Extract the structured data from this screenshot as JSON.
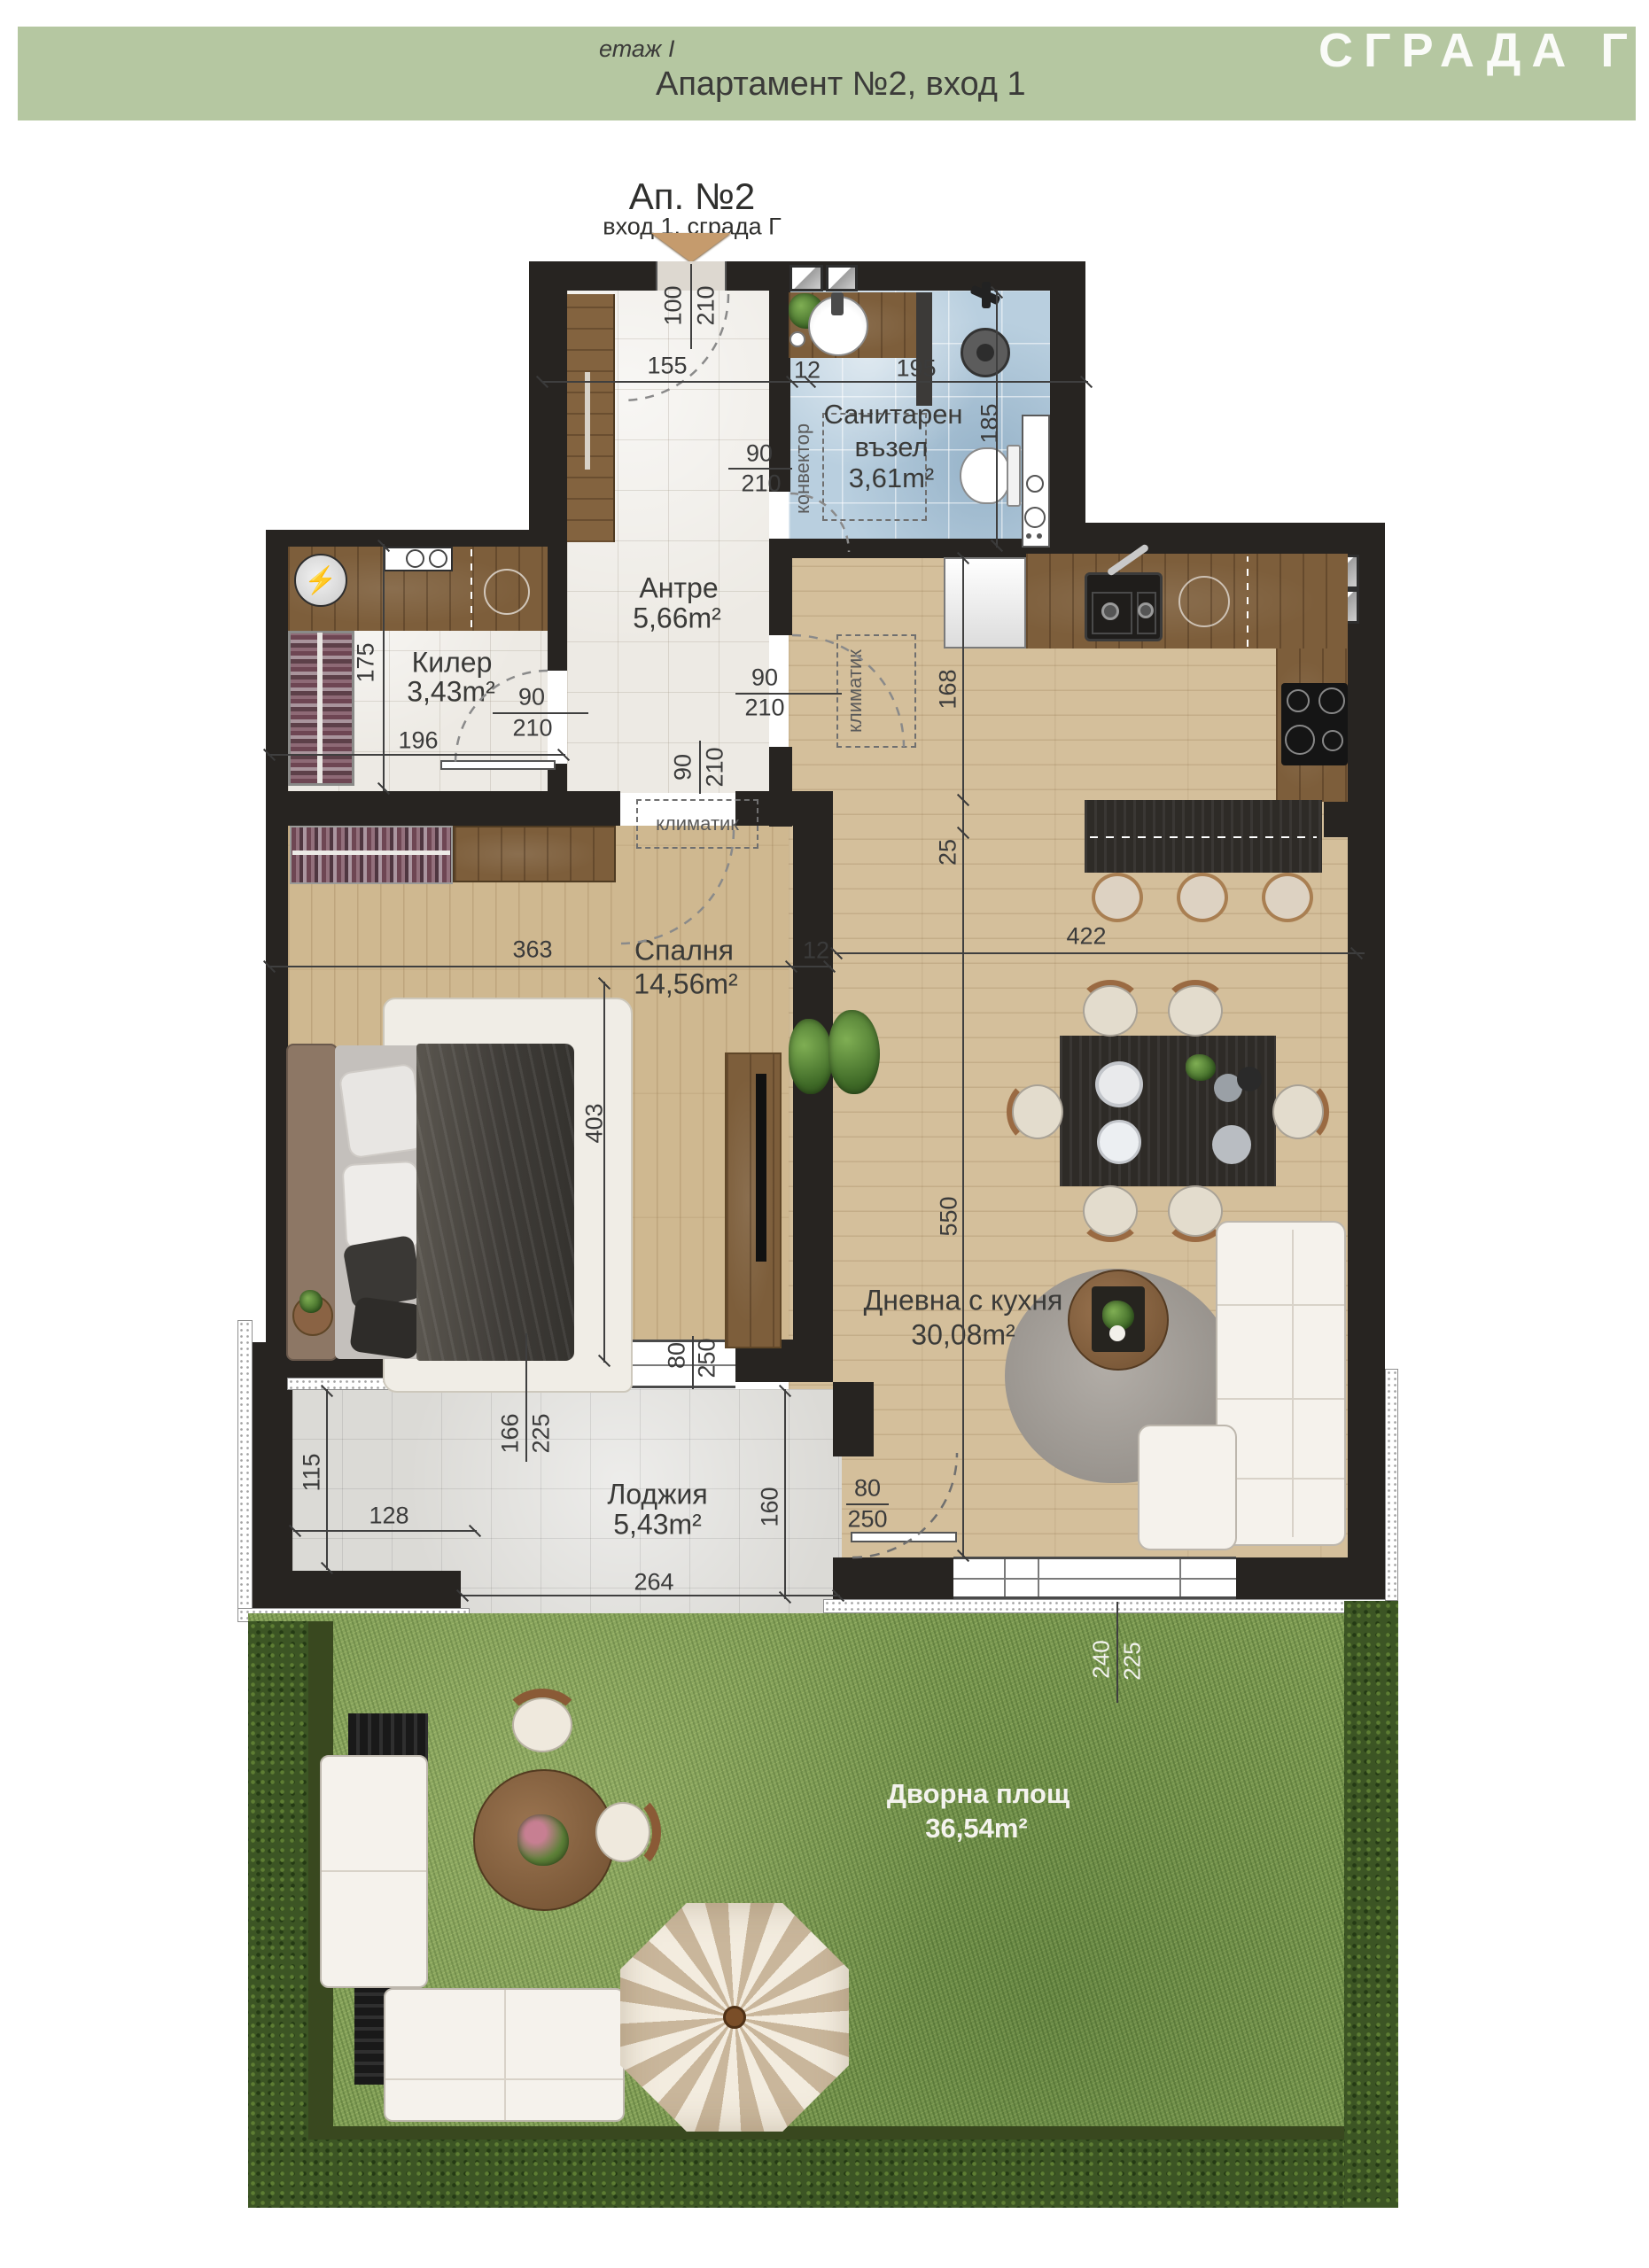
{
  "header": {
    "floor_label": "етаж I",
    "title": "Апартамент №2, вход 1",
    "building": "СГРАДА Г"
  },
  "marker": {
    "title": "Ап. №2",
    "subtitle": "вход 1, сграда Г"
  },
  "rooms": {
    "bathroom": {
      "line1": "Санитарен",
      "line2": "възел",
      "area": "3,61m²"
    },
    "entry": {
      "name": "Антре",
      "area": "5,66m²"
    },
    "storage": {
      "name": "Килер",
      "area": "3,43m²"
    },
    "bedroom": {
      "name": "Спалня",
      "area": "14,56m²"
    },
    "living": {
      "name": "Дневна с кухня",
      "area": "30,08m²"
    },
    "loggia": {
      "name": "Лоджия",
      "area": "5,43m²"
    },
    "yard": {
      "name": "Дворна площ",
      "area": "36,54m²"
    }
  },
  "labels": {
    "convector": "конвектор",
    "ac": "климатик"
  },
  "icons": {
    "washer": "⚡"
  },
  "dims": {
    "entry_w": "100",
    "entry_h": "210",
    "hall_a": "155",
    "wall12_a": "12",
    "hall_b": "195",
    "bath_h": "185",
    "bathdoor_w": "90",
    "bathdoor_h": "210",
    "storage_h": "175",
    "storage_w": "196",
    "storagedoor_w": "90",
    "storagedoor_h": "210",
    "beddoor_w": "90",
    "beddoor_h": "210",
    "livdoor_w": "90",
    "livdoor_h": "210",
    "kitchen_h": "168",
    "kitchen_gap": "25",
    "bed_w": "363",
    "wall12_b": "12",
    "bed_h": "403",
    "liv_w": "422",
    "liv_h": "550",
    "loggia_a": "115",
    "loggia_b": "128",
    "logwin_w": "166",
    "logwin_h": "225",
    "bldoor_w": "80",
    "bldoor_h": "250",
    "loggia_c": "264",
    "loggia_d": "160",
    "lldoor_w": "80",
    "lldoor_h": "250",
    "yard_w": "240",
    "yard_h": "225"
  },
  "colors": {
    "header_bar": "#b5c7a1",
    "wall": "#272421",
    "wood_floor": "#d4bf9b",
    "counter_wood": "#7d5e3b",
    "tile_light": "#edeae4",
    "tile_blue": "#b9cfdf",
    "loggia_tile": "#dbdad6",
    "grass": "#7e9c54",
    "hedge": "#3c5524",
    "entrance_arrow": "#c59b6d"
  }
}
